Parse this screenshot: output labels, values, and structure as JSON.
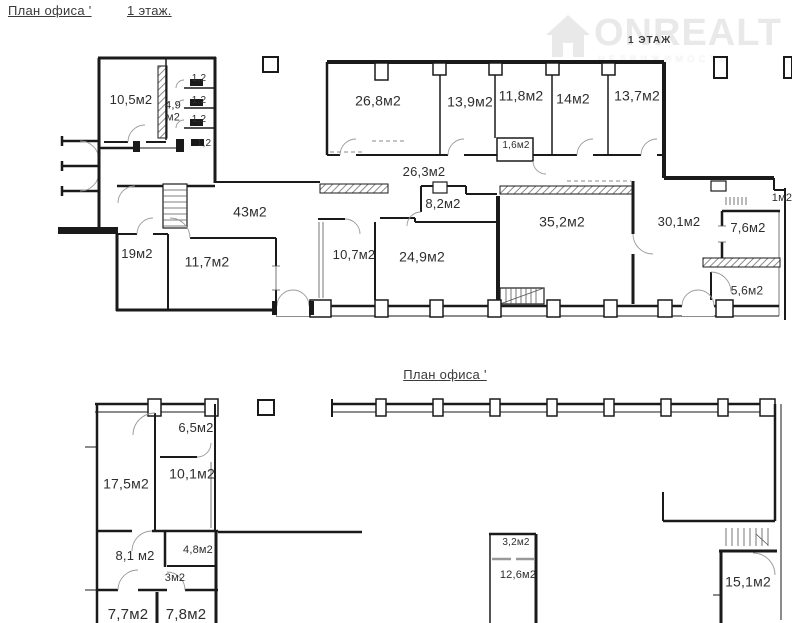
{
  "header": {
    "plan_title": "План офиса '",
    "floor_title": "1 этаж."
  },
  "watermark": {
    "brand": "ONREALT",
    "subtext": "НЕДВИЖИМОСТЬ",
    "floor_caption": "1 ЭТАЖ"
  },
  "colors": {
    "wall": "#1a1a1a",
    "label": "#2e2e2e",
    "watermark": "#e9e9e9",
    "door_arc": "#9a9a9a"
  },
  "floor1": {
    "rooms": {
      "r10_5": "10,5м2",
      "r4_9": "4,9\nм2",
      "stall1": "1,2",
      "stall2": "1,2",
      "stall3": "1,2",
      "stall4": "1,2",
      "r26_8": "26,8м2",
      "r13_9": "13,9м2",
      "r11_8": "11,8м2",
      "r14": "14м2",
      "r13_7": "13,7м2",
      "r1_6": "1,6м2",
      "r26_3": "26,3м2",
      "r43": "43м2",
      "r8_2": "8,2м2",
      "r19": "19м2",
      "r11_7": "11,7м2",
      "r10_7": "10,7м2",
      "r24_9": "24,9м2",
      "r35_2": "35,2м2",
      "r30_1": "30,1м2",
      "r7_6": "7,6м2",
      "r5_6": "5,6м2",
      "r1": "1м2"
    }
  },
  "floor2": {
    "title": "План офиса '",
    "rooms": {
      "r6_5": "6,5м2",
      "r17_5": "17,5м2",
      "r10_1": "10,1м2",
      "r8_1": "8,1 м2",
      "r4_8": "4,8м2",
      "r3": "3м2",
      "r7_7": "7,7м2",
      "r7_8": "7,8м2",
      "r3_2": "3,2м2",
      "r12_6": "12,6м2",
      "r15_1": "15,1м2"
    }
  }
}
